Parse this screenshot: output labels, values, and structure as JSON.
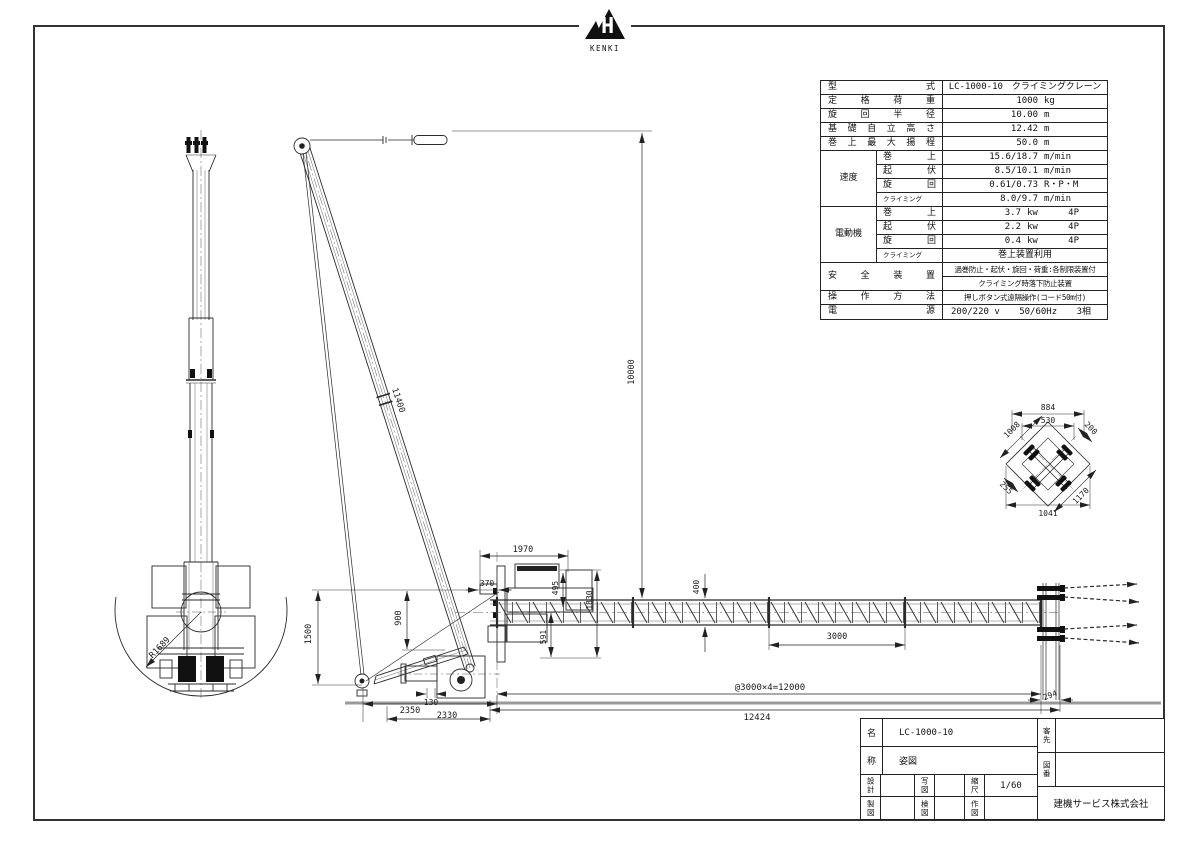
{
  "logo": {
    "text": "KENKI"
  },
  "spec": {
    "basic": [
      {
        "label": "型式",
        "value": "LC-1000-10　クライミングクレーン"
      },
      {
        "label": "定格荷重",
        "v": "1000",
        "u": "kg"
      },
      {
        "label": "旋回半径",
        "v": "10.00",
        "u": "m"
      },
      {
        "label": "基礎自立高さ",
        "v": "12.42",
        "u": "m"
      },
      {
        "label": "巻上最大揚程",
        "v": "50.0",
        "u": "m"
      }
    ],
    "speed": {
      "label": "速度",
      "rows": [
        {
          "s": "巻上",
          "v": "15.6/18.7",
          "u": "m/min"
        },
        {
          "s": "起伏",
          "v": "8.5/10.1",
          "u": "m/min"
        },
        {
          "s": "旋回",
          "v": "0.61/0.73",
          "u": "R・P・M"
        },
        {
          "s": "クライミング",
          "v": "8.0/9.7",
          "u": "m/min"
        }
      ]
    },
    "motor": {
      "label": "電動機",
      "rows": [
        {
          "s": "巻上",
          "v": "3.7",
          "u": "kw",
          "p": "4P"
        },
        {
          "s": "起伏",
          "v": "2.2",
          "u": "kw",
          "p": "4P"
        },
        {
          "s": "旋回",
          "v": "0.4",
          "u": "kw",
          "p": "4P"
        },
        {
          "s": "クライミング",
          "v": "巻上装置利用"
        }
      ]
    },
    "safety": {
      "label": "安全装置",
      "line1": "過巻防止・起伏・旋回・荷重:各制限装置付",
      "line2": "クライミング時落下防止装置"
    },
    "operation": {
      "label": "操作方法",
      "value": "押しボタン式遠隔操作(コード50m付)"
    },
    "power": {
      "label": "電源",
      "v1": "200/220 v",
      "v2": "50/60Hz",
      "v3": "3相"
    }
  },
  "titleblock": {
    "name_label": "名",
    "name_value": "LC-1000-10",
    "sub_label": "称",
    "sub_value": "姿図",
    "design_label": "設計",
    "copy_label": "写図",
    "scale_label": "縮尺",
    "scale_value": "1/60",
    "draft_label": "製図",
    "check_label": "検図",
    "make_label": "作図",
    "customer_label": "客先",
    "drawing_no_label": "図番",
    "company": "建機サービス株式会社"
  },
  "dims": {
    "boom_length": "11400",
    "hook_height": "10000",
    "machine_width": "1970",
    "offset_370": "370",
    "h495": "495",
    "h1830": "1830",
    "h591": "591",
    "h1500": "1500",
    "h900": "900",
    "mast_depth_400": "400",
    "segment_3000": "3000",
    "base_2350": "2350",
    "base_2330": "2330",
    "offset_130": "130",
    "mast_total": "@3000×4=12000",
    "overall_12424": "12424",
    "end_294": "294",
    "tail_radius": "R1689"
  },
  "detail": {
    "w884": "884",
    "w530": "530",
    "l1008": "1008",
    "l200": "200",
    "l255": "255",
    "l1170": "1170",
    "w1041": "1041"
  }
}
